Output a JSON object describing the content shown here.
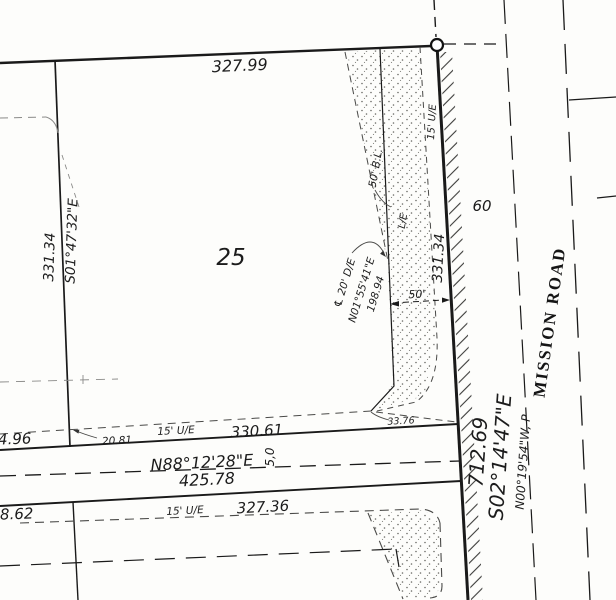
{
  "lot": {
    "number": "25",
    "north_distance": "327.99",
    "west_distance": "331.34",
    "west_bearing": "S01°47'32\"E",
    "east_distance": "331.34",
    "south_distance": "330.61"
  },
  "easements": {
    "utility_top": "15' U/E",
    "building_line": "50' B.L.",
    "landscape": "L/E",
    "drainage_centerline": "℄ 20' D/E",
    "drainage_bearing": "N01°55'41\"E",
    "drainage_distance": "198.94",
    "width_dim": "50'",
    "wedge_dim": "33.76",
    "utility_street": "15' U/E",
    "utility_south": "15' U/E"
  },
  "street": {
    "bearing": "N88°12'28\"E",
    "distance": "425.78",
    "half_width": "5,0",
    "offset": "20.81",
    "west_remainder": "4.96",
    "south_remainder": "8.62",
    "south_distance": "327.36"
  },
  "road": {
    "name": "MISSION ROAD",
    "width": "60",
    "boundary_distance": "712.69",
    "boundary_bearing": "S02°14'47\"E",
    "platted_bearing": "N00°19'54\"W, P"
  }
}
